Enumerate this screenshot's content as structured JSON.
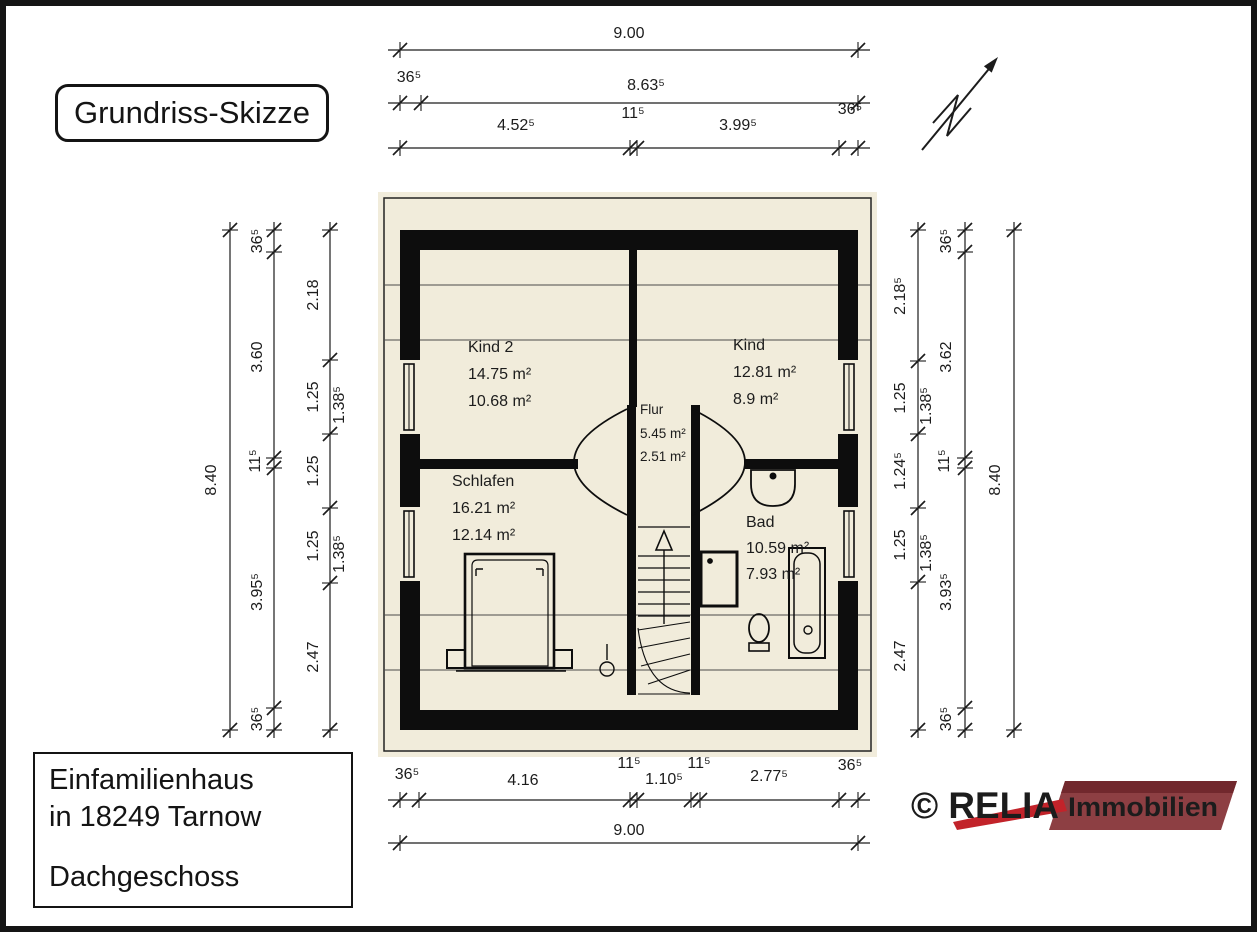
{
  "title": "Grundriss-Skizze",
  "info": {
    "line1": "Einfamilienhaus",
    "line2": "in 18249 Tarnow",
    "line3": "Dachgeschoss"
  },
  "logo": {
    "brand": "© RELIA",
    "suffix": "Immobilien",
    "brand_color": "#c2232a",
    "banner_color": "#8d3f43",
    "banner_top_color": "#71282d",
    "suffix_color": "#dcdadb"
  },
  "plan": {
    "rooms": {
      "kind2": {
        "name": "Kind 2",
        "area": "14.75 m²",
        "area_reduced": "10.68 m²"
      },
      "kind": {
        "name": "Kind",
        "area": "12.81 m²",
        "area_reduced": "8.9 m²"
      },
      "flur": {
        "name": "Flur",
        "area": "5.45 m²",
        "area_reduced": "2.51 m²"
      },
      "schlafen": {
        "name": "Schlafen",
        "area": "16.21 m²",
        "area_reduced": "12.14 m²"
      },
      "bad": {
        "name": "Bad",
        "area": "10.59 m²",
        "area_reduced": "7.93 m²"
      }
    },
    "dims": {
      "top": {
        "total": "9.00",
        "wall": "36⁵",
        "span": "8.63⁵",
        "row3": [
          "4.52⁵",
          "11⁵",
          "3.99⁵",
          "36⁵"
        ]
      },
      "bottom": {
        "row1": [
          "36⁵",
          "4.16",
          "11⁵",
          "1.10⁵",
          "11⁵",
          "2.77⁵",
          "36⁵"
        ],
        "total": "9.00"
      },
      "left": {
        "total": "8.40",
        "mid": [
          "36⁵",
          "3.60",
          "11⁵",
          "3.95⁵",
          "36⁵"
        ],
        "inner": [
          "2.18",
          "1.25",
          "1.38⁵",
          "1.25",
          "1.25",
          "1.38⁵",
          "2.47"
        ]
      },
      "right": {
        "total": "8.40",
        "mid": [
          "36⁵",
          "3.62",
          "11⁵",
          "3.93⁵",
          "36⁵"
        ],
        "inner": [
          "2.18⁵",
          "1.25",
          "1.38⁵",
          "1.24⁵",
          "1.25",
          "1.38⁵",
          "2.47"
        ]
      }
    }
  }
}
